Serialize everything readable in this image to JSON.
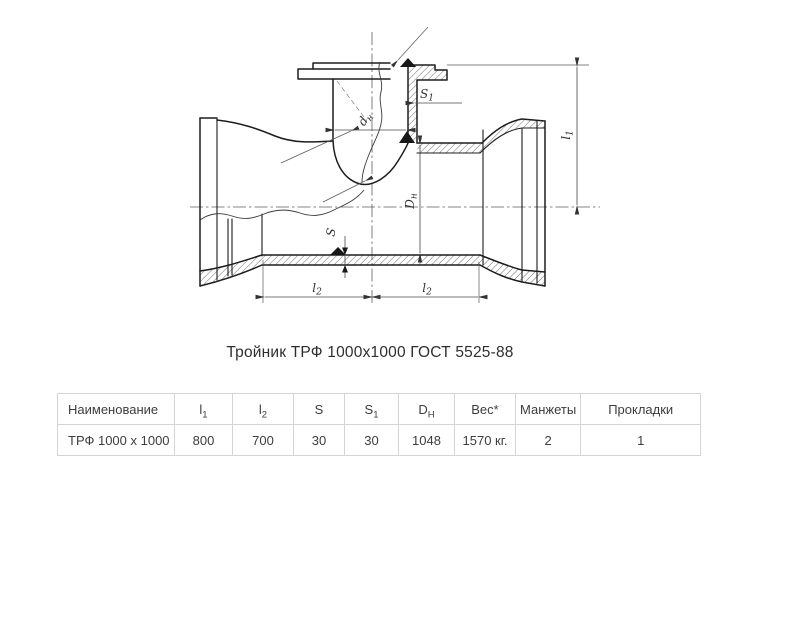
{
  "title": "Тройник ТРФ 1000х1000 ГОСТ 5525-88",
  "drawing": {
    "description": "sectional technical drawing of a flanged tee pipe fitting",
    "labels": {
      "dn": {
        "base": "d",
        "sub": "н"
      },
      "s1": {
        "base": "S",
        "sub": "1"
      },
      "s": "S",
      "Dn": {
        "base": "D",
        "sub": "н"
      },
      "l1": {
        "base": "l",
        "sub": "1"
      },
      "l2_left": {
        "base": "l",
        "sub": "2"
      },
      "l2_right": {
        "base": "l",
        "sub": "2"
      }
    }
  },
  "table": {
    "columns": [
      {
        "label": "Наименование"
      },
      {
        "base": "l",
        "sub": "1"
      },
      {
        "base": "l",
        "sub": "2"
      },
      {
        "label": "S"
      },
      {
        "base": "S",
        "sub": "1"
      },
      {
        "base": "D",
        "sub": "H"
      },
      {
        "label": "Вес*"
      },
      {
        "label": "Манжеты"
      },
      {
        "label": "Прокладки"
      }
    ],
    "rows": [
      [
        "ТРФ 1000 х 1000",
        "800",
        "700",
        "30",
        "30",
        "1048",
        "1570 кг.",
        "2",
        "1"
      ]
    ]
  },
  "colors": {
    "background": "#ffffff",
    "outline": "#1d1d1d",
    "thin_line": "#4a4a4a",
    "text": "#3d3d3d",
    "table_border": "#d4d4d4"
  }
}
